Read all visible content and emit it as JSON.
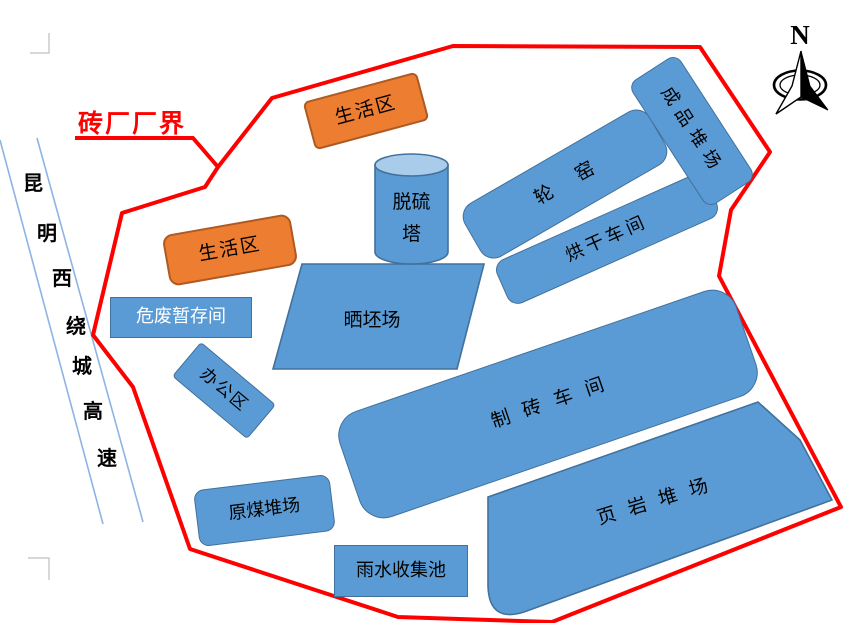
{
  "boundary": {
    "label": "砖厂厂界",
    "color": "#FF0000"
  },
  "compass": {
    "label": "N"
  },
  "road": {
    "name": "昆明西绕城高速",
    "chars": [
      "昆",
      "明",
      "西",
      "绕",
      "城",
      "高",
      "速"
    ]
  },
  "areas": {
    "living_area_top": "生活区",
    "living_area_left": "生活区",
    "desulfurization_tower_line1": "脱硫",
    "desulfurization_tower_line2": "塔",
    "ring_kiln": "轮窑",
    "drying_workshop": "烘干车间",
    "finished_goods_yard": "成品堆场",
    "hazardous_waste_room": "危废暂存间",
    "office_area": "办公区",
    "brick_drying_field": "晒坯场",
    "brick_workshop": "制砖车间",
    "shale_yard": "页岩堆场",
    "raw_coal_yard": "原煤堆场",
    "rainwater_pool": "雨水收集池"
  },
  "colors": {
    "facility_blue": "#5B9BD5",
    "facility_blue_border": "#41719C",
    "cylinder_top_blue": "#A9CCEA",
    "living_orange": "#ED7D31",
    "living_orange_border": "#AE5A21",
    "boundary_red": "#FF0000",
    "road_line_blue": "#8EB4E3",
    "page_mark_gray": "#BFBFBF"
  }
}
